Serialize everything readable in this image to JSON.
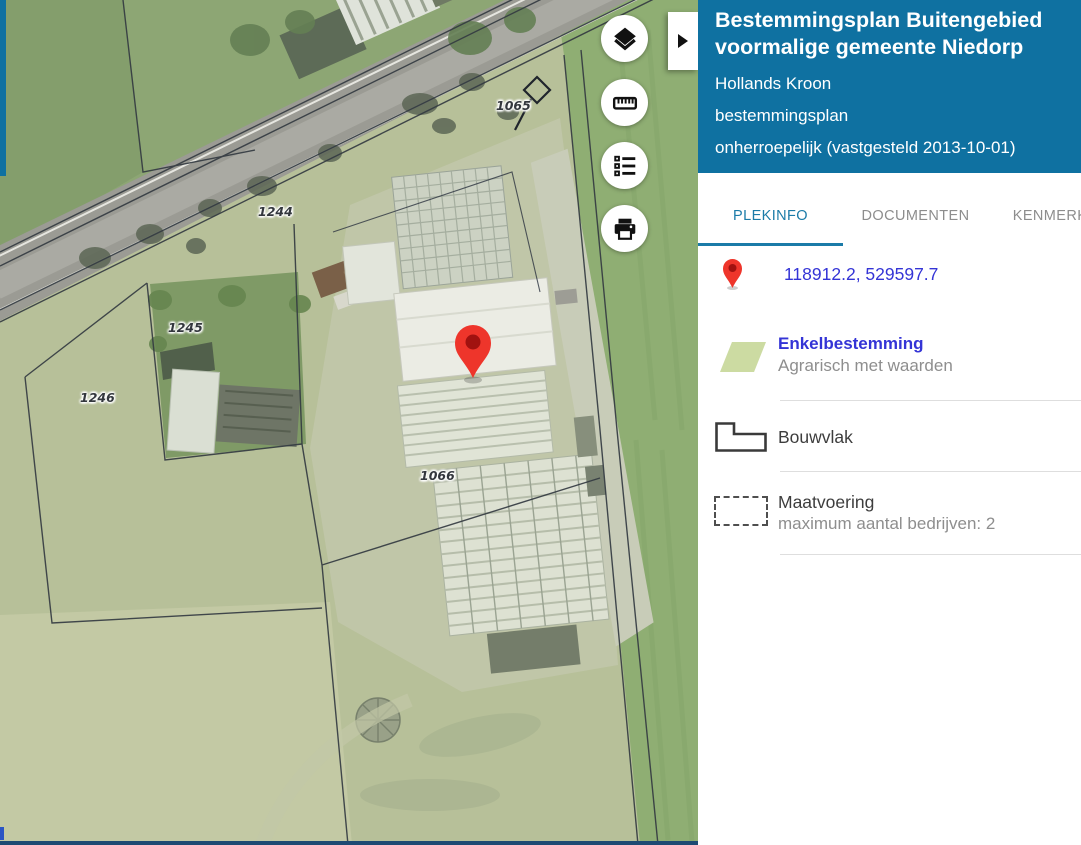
{
  "panel": {
    "header": {
      "title": "Bestemmingsplan Buitengebied voormalige gemeente Niedorp",
      "municipality": "Hollands Kroon",
      "plan_type": "bestemmingsplan",
      "status": "onherroepelijk (vastgesteld 2013-10-01)"
    },
    "tabs": [
      {
        "label": "PLEKINFO",
        "active": true
      },
      {
        "label": "DOCUMENTEN",
        "active": false
      },
      {
        "label": "KENMERKEN",
        "active": false
      }
    ],
    "location": {
      "coordinates": "118912.2, 529597.7"
    },
    "legend": [
      {
        "kind": "enkelbestemming",
        "title": "Enkelbestemming",
        "subtitle": "Agrarisch met waarden",
        "swatch_color": "#ccdba2"
      },
      {
        "kind": "bouwvlak",
        "title": "Bouwvlak"
      },
      {
        "kind": "maatvoering",
        "title": "Maatvoering",
        "subtitle": "maximum aantal bedrijven: 2"
      }
    ]
  },
  "map": {
    "labels": [
      {
        "text": "1065"
      },
      {
        "text": "1244"
      },
      {
        "text": "1245"
      },
      {
        "text": "1246"
      },
      {
        "text": "1066"
      }
    ],
    "controls": [
      {
        "icon": "layers-icon"
      },
      {
        "icon": "ruler-icon"
      },
      {
        "icon": "legend-list-icon"
      },
      {
        "icon": "printer-icon"
      }
    ],
    "marker": {
      "color": "#ee352b"
    }
  },
  "colors": {
    "header_blue": "#0f71a1",
    "tab_active": "#1b7ba8",
    "link_blue": "#3434d6",
    "bottom_bar": "#1d4a73"
  }
}
